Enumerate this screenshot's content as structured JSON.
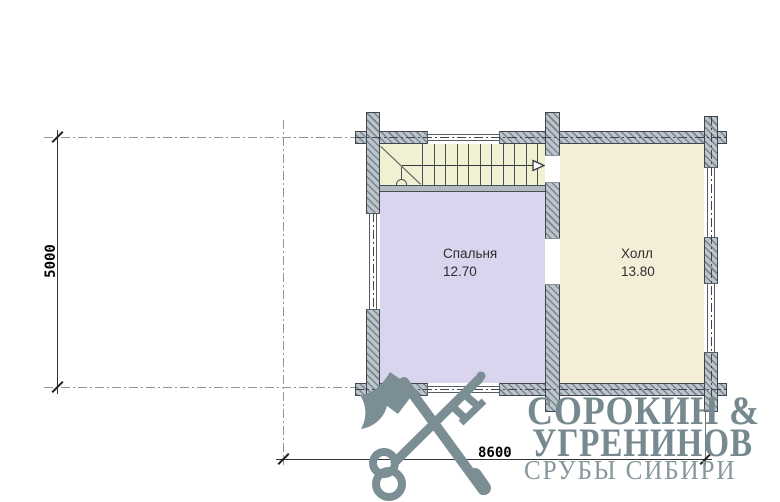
{
  "plan": {
    "rooms": [
      {
        "name": "Спальня",
        "area": "12.70"
      },
      {
        "name": "Холл",
        "area": "13.80"
      }
    ],
    "dimensions": {
      "vertical": "5000",
      "horizontal": "8600"
    }
  },
  "logo": {
    "line1": "СОРОКИН &",
    "line2": "УГРЕНИНОВ",
    "line3": "СРУБЫ СИБИРИ"
  },
  "icons": {
    "emblem": "axe-and-key-emblem"
  },
  "colors": {
    "bedroom_fill": "#d9d5ef",
    "hall_fill": "#f4eed8",
    "stair_fill": "#f0f1d2",
    "wall_fill": "#bdc5cc",
    "wall_hatch": "#79848e",
    "logo": "#76898f"
  }
}
